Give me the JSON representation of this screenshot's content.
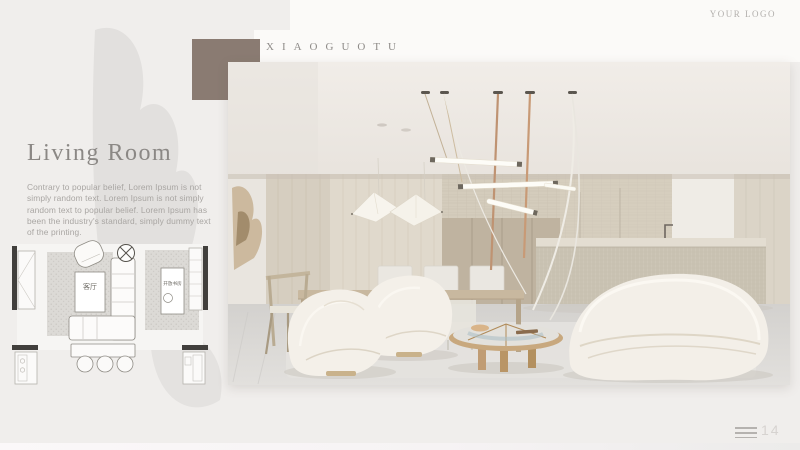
{
  "header": {
    "logo": "YOUR LOGO",
    "brand": "XIAOGUOTU"
  },
  "section": {
    "title": "Living Room",
    "description": "Contrary to popular belief, Lorem Ipsum is not simply random text. Lorem Ipsum is not simply random text to popular belief. Lorem Ipsum has been the industry's standard, simply dummy text of the printing."
  },
  "floor_plan": {
    "living_label": "客厅",
    "study_label": "开放书房"
  },
  "footer": {
    "page_number": "14"
  },
  "colors": {
    "accent_square": "#8a7b72",
    "page_background": "#f0eeec",
    "title_gray": "#8b8885"
  }
}
